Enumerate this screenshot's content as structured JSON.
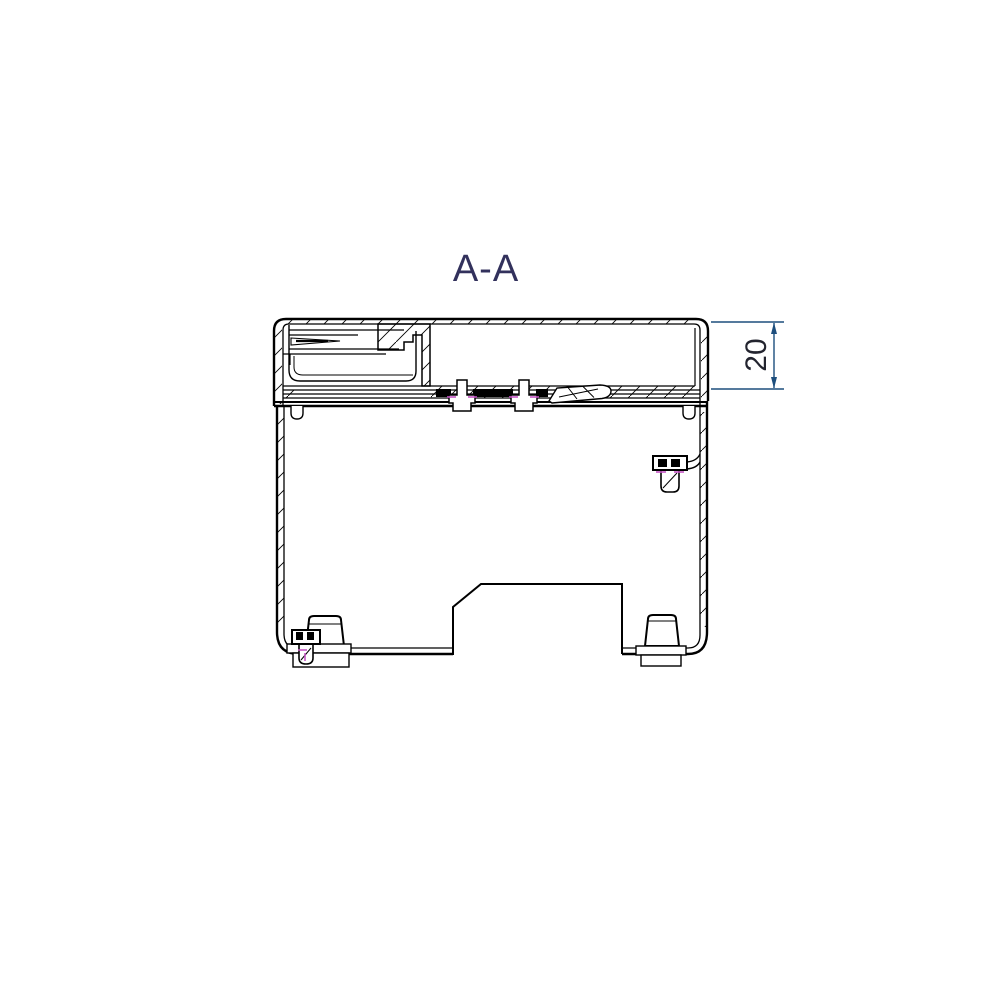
{
  "page": {
    "background": "#ffffff"
  },
  "drawing": {
    "title": "A-A",
    "title_color": "#32315c",
    "line_color": "#000000",
    "centerline_color": "#c455c4",
    "dimension": {
      "value": "20",
      "line_color": "#1d4e7d",
      "text_color": "#23242f"
    }
  }
}
